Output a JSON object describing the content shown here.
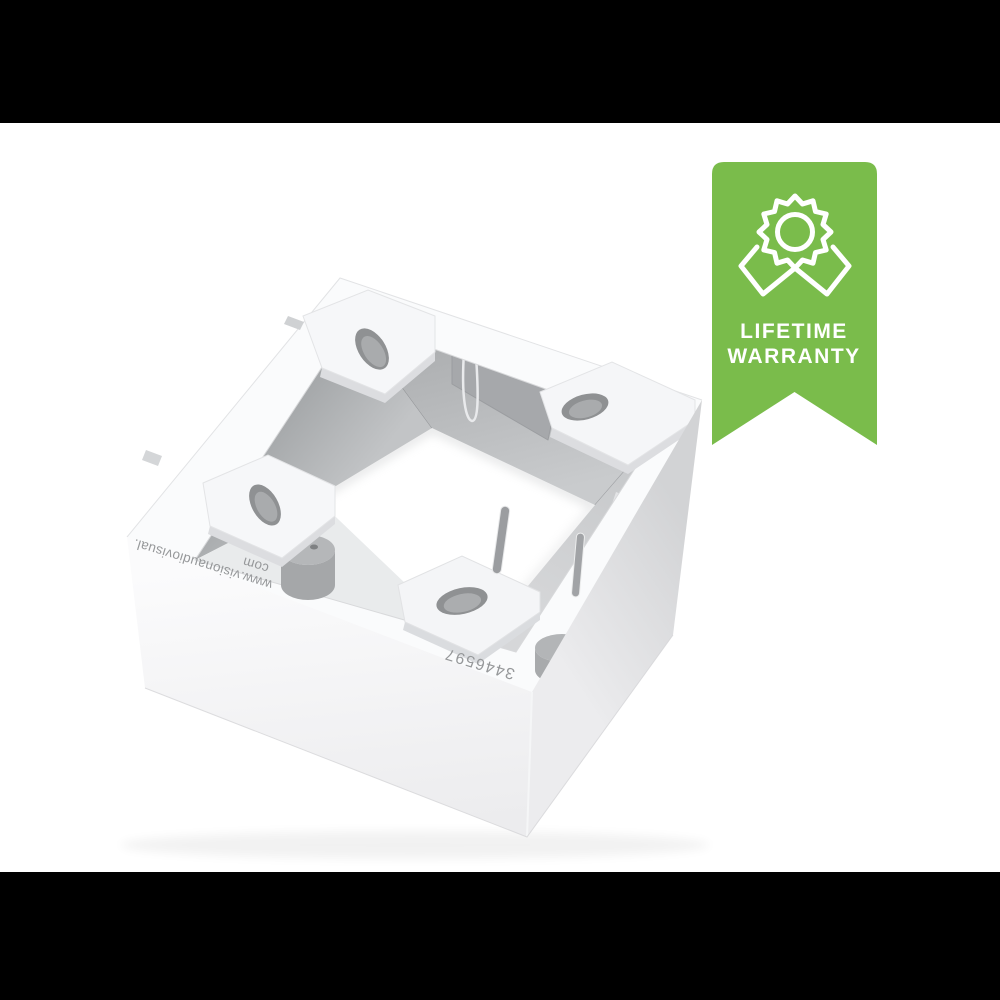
{
  "scene": {
    "type": "product-photo",
    "background_color": "#ffffff",
    "letterbox_color": "#000000"
  },
  "product": {
    "name": "white surface-mount back box, single gang, open top",
    "body_color": "#f6f7f8",
    "shade_color": "#d8d9db",
    "interior_color": "#a9abad",
    "markings": {
      "url_line1": "www.visionaudiovisual.",
      "url_line2": "com",
      "part_number": "3446597",
      "text_color": "#96989a",
      "orientation": "upside-down"
    }
  },
  "badge": {
    "line1": "LIFETIME",
    "line2": "WARRANTY",
    "ribbon_color": "#7abc4b",
    "text_color": "#ffffff",
    "icon": "award-rosette-icon"
  }
}
